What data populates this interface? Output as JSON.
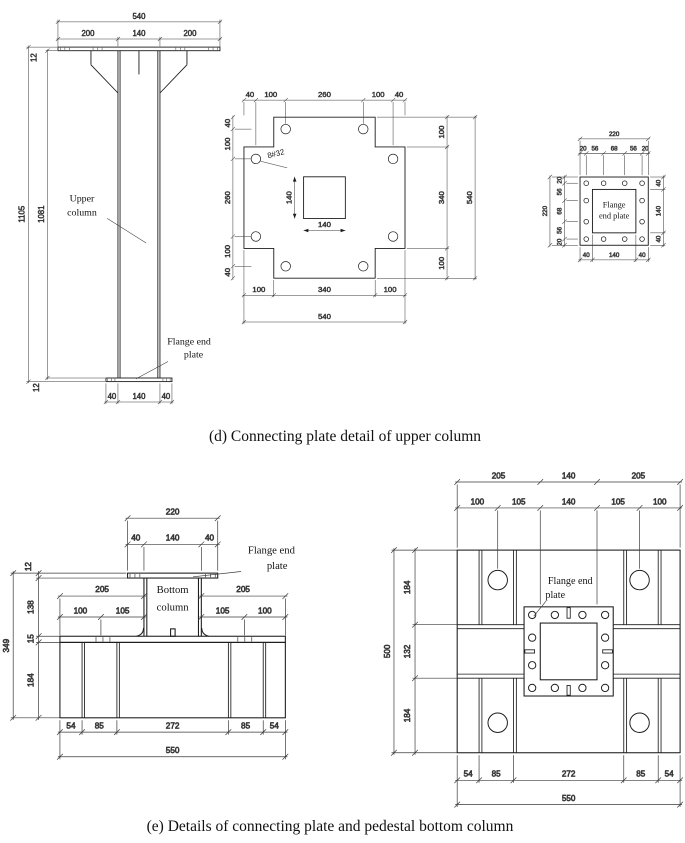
{
  "captions": {
    "d": "(d) Connecting plate detail of upper column",
    "e": "(e) Details of connecting plate and pedestal bottom column"
  },
  "colors": {
    "line": "#1c1c1c",
    "background": "#ffffff"
  },
  "upper_elevation": {
    "labels": {
      "upper_column": [
        "Upper",
        "column"
      ],
      "flange_end_plate": [
        "Flange end",
        "plate"
      ]
    },
    "dims": {
      "top_total": "540",
      "top": [
        "200",
        "140",
        "200"
      ],
      "thk_top": "12",
      "height_outer": "1105",
      "height_inner": "1081",
      "thk_bottom": "12",
      "bottom": [
        "40",
        "140",
        "40"
      ]
    }
  },
  "upper_plan": {
    "note": "8#32",
    "dims": {
      "top": [
        "40",
        "100",
        "260",
        "100",
        "40"
      ],
      "left": [
        "40",
        "100",
        "260",
        "100",
        "40"
      ],
      "right": [
        "100",
        "340",
        "100"
      ],
      "right_total": "540",
      "bottom": [
        "100",
        "340",
        "100"
      ],
      "bottom_total": "540",
      "column_w": "140",
      "column_h": "140"
    }
  },
  "flange_plate": {
    "label": [
      "Flange",
      "end plate"
    ],
    "dims": {
      "top_total": "220",
      "top": [
        "20",
        "56",
        "68",
        "56",
        "20"
      ],
      "left_total": "220",
      "left": [
        "20",
        "56",
        "68",
        "56",
        "20"
      ],
      "right": [
        "40",
        "140",
        "40"
      ],
      "bottom": [
        "40",
        "140",
        "40"
      ]
    }
  },
  "bottom_elevation": {
    "labels": {
      "flange_end_plate": [
        "Flange end",
        "plate"
      ],
      "bottom_column": [
        "Bottom",
        "column"
      ]
    },
    "dims": {
      "top_total": "220",
      "top": [
        "40",
        "140",
        "40"
      ],
      "left": [
        "12",
        "138",
        "15",
        "184"
      ],
      "left_total": "349",
      "mid_left_total": "205",
      "mid_left": [
        "100",
        "105"
      ],
      "mid_right_total": "205",
      "mid_right": [
        "105",
        "100"
      ],
      "bottom": [
        "54",
        "85",
        "272",
        "85",
        "54"
      ],
      "bottom_total": "550"
    }
  },
  "pedestal_plan": {
    "labels": {
      "flange_end_plate": [
        "Flange end",
        "plate"
      ]
    },
    "dims": {
      "top": [
        "205",
        "140",
        "205"
      ],
      "top2": [
        "100",
        "105",
        "140",
        "105",
        "100"
      ],
      "left_total": "500",
      "left": [
        "184",
        "132",
        "184"
      ],
      "bottom": [
        "54",
        "85",
        "272",
        "85",
        "54"
      ],
      "bottom_total": "550"
    }
  }
}
